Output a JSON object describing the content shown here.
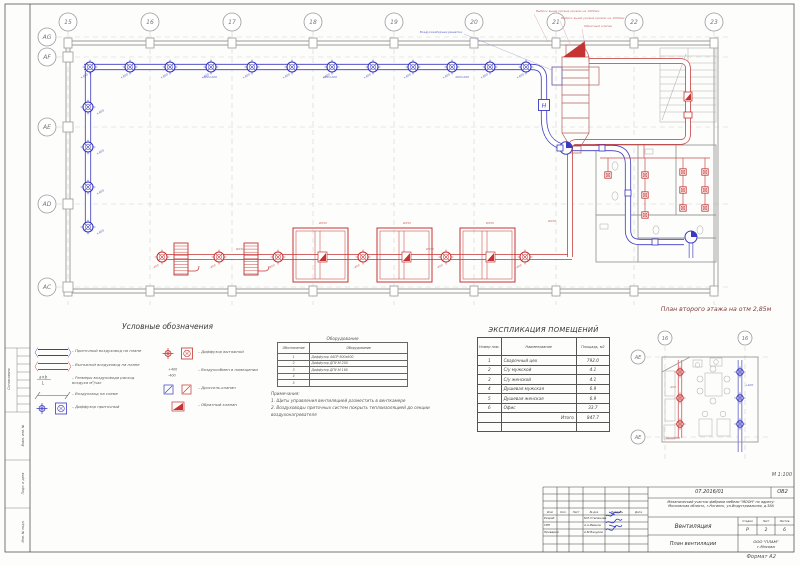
{
  "sheet": {
    "scale_label": "М 1:100",
    "format_label": "Формат А2",
    "margin_stamps": [
      "Согласовано",
      "Взам. инв. №",
      "Подп. и дата",
      "Инв. № подл."
    ]
  },
  "grid": {
    "columns": [
      "15",
      "16",
      "17",
      "18",
      "19",
      "20",
      "21",
      "22",
      "23"
    ],
    "rows": [
      "AG",
      "AF",
      "AE",
      "AD",
      "AC"
    ]
  },
  "plan_main": {
    "annotations": {
      "intake": "Воздухозаборная решетка",
      "exhaust_note_1": "Выброс выше уровня кровли на 1000мм",
      "exhaust_note_2": "Выброс выше уровня кровли на 1000мм",
      "check_valve": "Обратный клапан",
      "supply_flow": "+400",
      "exhaust_flow": "-400",
      "supply_size": "400×200",
      "exhaust_size": "Ø250",
      "fan_mark": "Н"
    }
  },
  "plan_second": {
    "title": "План второго этажа на отм 2,85м",
    "grid_columns": [
      "16",
      "16"
    ],
    "grid_rows": [
      "AE",
      "AE"
    ]
  },
  "legend": {
    "title": "Условные обозначения",
    "items_left": [
      {
        "symbol": "duct-supply",
        "label": "Приточный воздуховод на плане"
      },
      {
        "symbol": "duct-exhaust",
        "label": "Вытяжной воздуховод на плане"
      },
      {
        "symbol": "size-callout",
        "label": "Размеры воздуховода расход воздуха м³/час"
      },
      {
        "symbol": "duct-scheme",
        "label": "Воздуховод на схеме"
      },
      {
        "symbol": "diffuser-supply",
        "label": "Диффузор приточный"
      }
    ],
    "items_right": [
      {
        "symbol": "diffuser-exhaust",
        "label": "Диффузор вытяжной"
      },
      {
        "symbol": "airflow",
        "label": "Воздухообмен в помещении"
      },
      {
        "symbol": "damper",
        "label": "Дроссель-клапан"
      },
      {
        "symbol": "check-valve",
        "label": "Обратный клапан"
      }
    ]
  },
  "equipment_table": {
    "title": "Оборудование",
    "headers": [
      "Обозначение",
      "Оборудование"
    ],
    "rows": [
      [
        "1",
        "Диффузор 4АПР 600х600"
      ],
      [
        "2",
        "Диффузор ДПУ-М 200"
      ],
      [
        "3",
        "Диффузор ДПУ-М 160"
      ],
      [
        "4",
        ""
      ],
      [
        "5",
        ""
      ]
    ]
  },
  "notes": {
    "title": "Примечания:",
    "lines": [
      "1. Щиты управления вентиляцией разместить в венткамере",
      "2. Воздуховоды приточных систем покрыть теплоизоляцией до секции",
      "воздухонагревателя"
    ]
  },
  "explication": {
    "title": "ЭКСПЛИКАЦИЯ ПОМЕЩЕНИЙ",
    "headers": [
      "Номер пом.",
      "Наименование",
      "Площадь, м2"
    ],
    "rows": [
      [
        "1",
        "Сварочный цех",
        "792.0"
      ],
      [
        "2",
        "С/у мужской",
        "4.1"
      ],
      [
        "3",
        "С/у женской",
        "4.1"
      ],
      [
        "4",
        "Душевая мужская",
        "6.9"
      ],
      [
        "5",
        "Душевая женская",
        "6.9"
      ],
      [
        "6",
        "Офис",
        "33.7"
      ]
    ],
    "total_label": "Итого",
    "total_value": "847.7"
  },
  "title_block": {
    "project_code": "07.2016/01",
    "doc_code": "ОВ2",
    "description_line1": "Механический участок фабрики мебели \"МООН\" по адресу:",
    "description_line2": "Московская область, г.Ногинск, ул.Индустриальная, д.38А",
    "header_cols": [
      "Изм",
      "Кол",
      "Лист",
      "№ док",
      "Подпись",
      "Дата"
    ],
    "roles": [
      {
        "role": "Разраб",
        "name": "М.Е.Степанова"
      },
      {
        "role": "ГИП",
        "name": "А.А.Иванов"
      },
      {
        "role": "Проверил",
        "name": "А.М.Вакуров"
      }
    ],
    "section_title": "Вентиляция",
    "stage_header": [
      "Стадия",
      "Лист",
      "Листов"
    ],
    "stage_values": [
      "Р",
      "2",
      "6"
    ],
    "sheet_title": "План вентиляции",
    "company_line1": "ООО \"ПЛАМ\"",
    "company_line2": "г.Москва"
  },
  "colors": {
    "supply": "#3a3ac0",
    "exhaust": "#c43434",
    "wall": "#9a9a9a",
    "grid_line": "#cfcfcf"
  }
}
